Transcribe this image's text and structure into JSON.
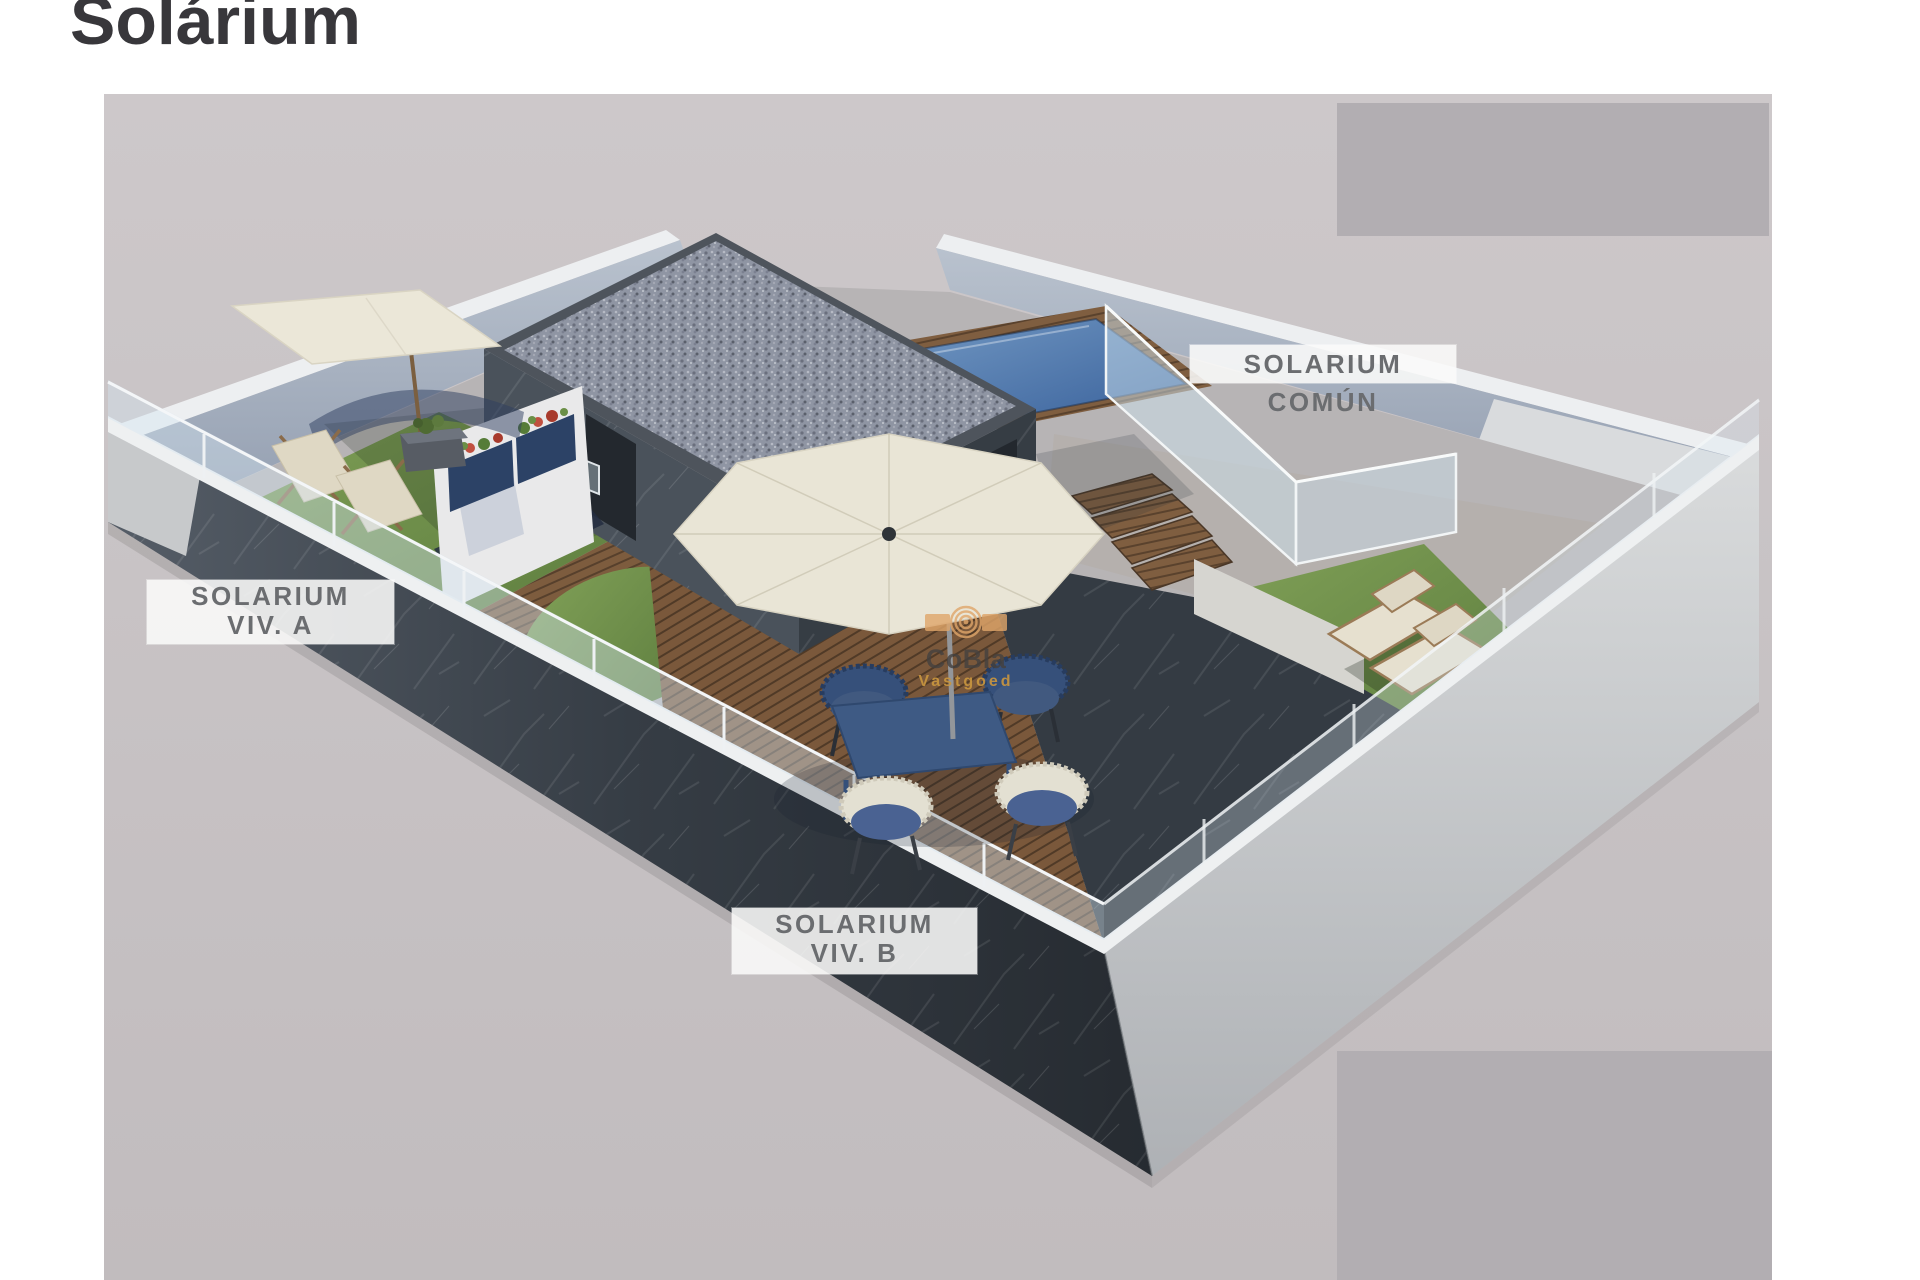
{
  "page": {
    "title": "Solárium",
    "background_color": "#ffffff"
  },
  "render": {
    "name": "rooftop-solarium-3d-render",
    "labels": {
      "comun": "SOLARIUM COMÚN",
      "viv_a_line1": "SOLARIUM",
      "viv_a_line2": "VIV. A",
      "viv_b_line1": "SOLARIUM",
      "viv_b_line2": "VIV. B"
    },
    "label_style": {
      "background": "rgba(250,250,249,0.88)",
      "text_color": "#6b6d70"
    },
    "palette": {
      "floor_background": "#c9c4c6",
      "redaction_block": "#b1adb1",
      "wall_dark_marble": "#3b424a",
      "wall_inner_light": "#a9b3c1",
      "wall_cap_white": "#eef0f1",
      "grass": "#6d8f48",
      "wood_deck": "#7b5a3f",
      "pool_water": "#527cab",
      "gravel_roof": "#8f95a3",
      "parasol_canvas": "#ebe7d8",
      "furniture_blue": "#3c5378",
      "glass": "#d6e4ec"
    },
    "redaction_blocks": 2
  },
  "watermark": {
    "brand": "CoBla",
    "tagline": "Vastgoed",
    "logo_icon": "cobla-sun-rings-icon",
    "accent_color": "#e0a66a",
    "tagline_color": "#c8953f"
  }
}
